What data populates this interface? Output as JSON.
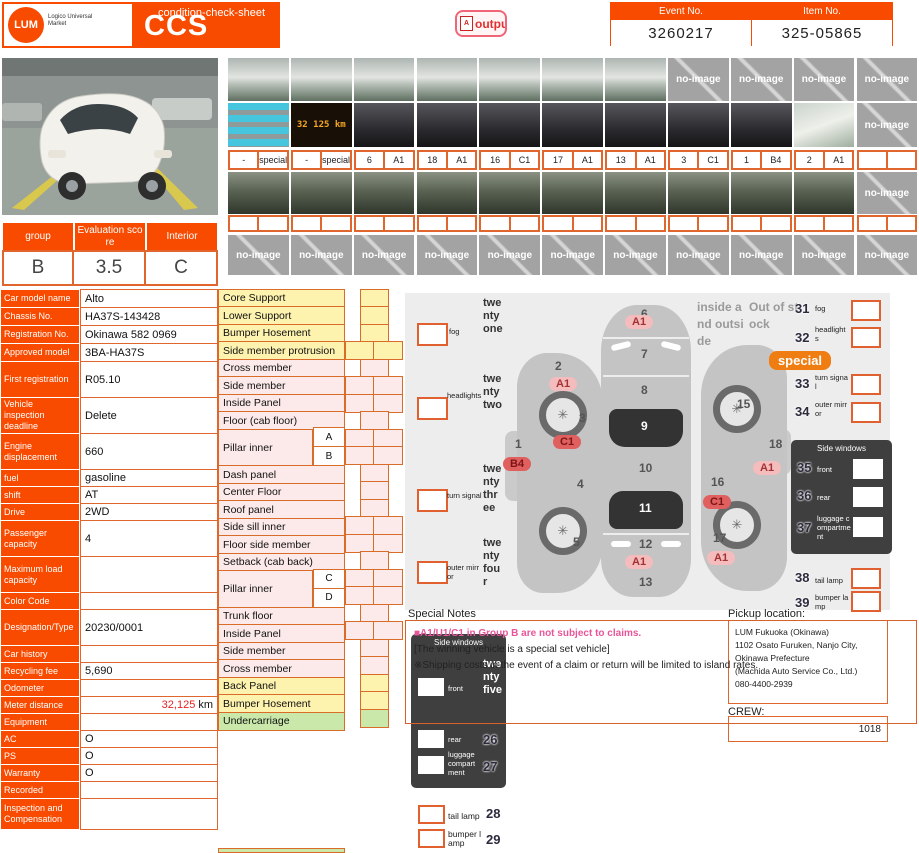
{
  "header": {
    "logo_text": "LUM",
    "logo_sub": "Logico Universal Market",
    "title": "CCS",
    "subtitle": "condition-check-sheet",
    "output_button": "output",
    "output_icon": "pdf-icon",
    "event": {
      "label": "Event No.",
      "value": "3260217"
    },
    "item": {
      "label": "Item No.",
      "value": "325-05865"
    }
  },
  "photos": {
    "no_image": "no-image",
    "odometer_display": "32 125 km",
    "row1_types": [
      "ext",
      "ext",
      "ext",
      "ext",
      "ext",
      "ext",
      "ext",
      "no",
      "no",
      "no",
      "no"
    ],
    "row2_types": [
      "cyan",
      "odo",
      "int",
      "int",
      "int",
      "int",
      "int",
      "int",
      "int",
      "doc",
      "no"
    ],
    "row3_types": [
      "und",
      "und",
      "und",
      "und",
      "und",
      "und",
      "und",
      "und",
      "und",
      "und",
      "no"
    ],
    "row4_types": [
      "no",
      "no",
      "no",
      "no",
      "no",
      "no",
      "no",
      "no",
      "no",
      "no",
      "no"
    ],
    "tag_row1": [
      [
        "-",
        "special"
      ],
      [
        "-",
        "special"
      ],
      [
        "6",
        "A1"
      ],
      [
        "18",
        "A1"
      ],
      [
        "16",
        "C1"
      ],
      [
        "17",
        "A1"
      ],
      [
        "13",
        "A1"
      ],
      [
        "3",
        "C1"
      ],
      [
        "1",
        "B4"
      ],
      [
        "2",
        "A1"
      ],
      [
        "",
        ""
      ]
    ],
    "tag_row2": [
      [
        "",
        ""
      ],
      [
        "",
        ""
      ],
      [
        "",
        ""
      ],
      [
        "",
        ""
      ],
      [
        "",
        ""
      ],
      [
        "",
        ""
      ],
      [
        "",
        ""
      ],
      [
        "",
        ""
      ],
      [
        "",
        ""
      ],
      [
        "",
        ""
      ],
      [
        "",
        ""
      ]
    ]
  },
  "summary": {
    "columns": [
      {
        "label": "group",
        "value": "B"
      },
      {
        "label": "Evaluation score",
        "value": "3.5"
      },
      {
        "label": "Interior",
        "value": "C"
      }
    ]
  },
  "details": {
    "meter_value": "32,125",
    "meter_unit": "km",
    "rows": [
      {
        "label": "Car model name",
        "value": "Alto"
      },
      {
        "label": "Chassis No.",
        "value": "HA37S-143428"
      },
      {
        "label": "Registration No.",
        "value": "Okinawa 582 0969"
      },
      {
        "label": "Approved model",
        "value": "3BA-HA37S"
      },
      {
        "label": "First registration",
        "value": "R05.10"
      },
      {
        "label": "Vehicle inspection deadline",
        "value": "Delete"
      },
      {
        "label": "Engine displacement",
        "value": "660"
      },
      {
        "label": "fuel",
        "value": "gasoline"
      },
      {
        "label": "shift",
        "value": "AT"
      },
      {
        "label": "Drive",
        "value": "2WD"
      },
      {
        "label": "Passenger capacity",
        "value": "4"
      },
      {
        "label": "Maximum load capacity",
        "value": ""
      },
      {
        "label": "Color Code",
        "value": ""
      },
      {
        "label": "Designation/Type",
        "value": "20230/0001"
      },
      {
        "label": "Car history",
        "value": ""
      },
      {
        "label": "Recycling fee",
        "value": "5,690"
      },
      {
        "label": "Odometer",
        "value": ""
      },
      {
        "label": "Meter distance",
        "value": "",
        "meter": true
      },
      {
        "label": "Equipment",
        "value": ""
      },
      {
        "label": "AC",
        "value": "O"
      },
      {
        "label": "PS",
        "value": "O"
      },
      {
        "label": "Warranty",
        "value": "O"
      },
      {
        "label": "Recorded",
        "value": ""
      },
      {
        "label": "Inspection and Compensation",
        "value": ""
      }
    ]
  },
  "parts": {
    "rows": [
      {
        "label": "Core Support",
        "color": "yel",
        "strip": "s"
      },
      {
        "label": "Lower Support",
        "color": "yel",
        "strip": "s"
      },
      {
        "label": "Bumper Hosement",
        "color": "yel",
        "strip": "s"
      },
      {
        "label": "Side member protrusion",
        "color": "yel",
        "strip": "p"
      },
      {
        "label": "Cross member",
        "color": "pnk",
        "strip": "s"
      },
      {
        "label": "Side member",
        "color": "pnk",
        "strip": "p"
      },
      {
        "label": "Inside Panel",
        "color": "pnk",
        "strip": "p"
      },
      {
        "label": "Floor (cab floor)",
        "color": "pnk",
        "strip": "s"
      },
      {
        "label": "Pillar inner",
        "color": "pnk",
        "strip": "p2",
        "sub": [
          "A",
          "B"
        ]
      },
      {
        "label": "Dash panel",
        "color": "pnk",
        "strip": "s"
      },
      {
        "label": "Center Floor",
        "color": "pnk",
        "strip": "s"
      },
      {
        "label": "Roof panel",
        "color": "pnk",
        "strip": "s"
      },
      {
        "label": "Side sill inner",
        "color": "pnk",
        "strip": "p"
      },
      {
        "label": "Floor side member",
        "color": "pnk",
        "strip": "p"
      },
      {
        "label": "Setback (cab back)",
        "color": "pnk",
        "strip": "s"
      },
      {
        "label": "Pillar inner",
        "color": "pnk",
        "strip": "p2",
        "sub": [
          "C",
          "D"
        ]
      },
      {
        "label": "Trunk floor",
        "color": "pnk",
        "strip": "s"
      },
      {
        "label": "Inside Panel",
        "color": "pnk",
        "strip": "p"
      },
      {
        "label": "Side member",
        "color": "pnk",
        "strip": "s"
      },
      {
        "label": "Cross member",
        "color": "pnk",
        "strip": "s"
      },
      {
        "label": "Back Panel",
        "color": "yel",
        "strip": "s"
      },
      {
        "label": "Bumper Hosement",
        "color": "yel",
        "strip": "s"
      },
      {
        "label": "Undercarriage",
        "color": "grn",
        "strip": "s"
      }
    ]
  },
  "diagram": {
    "zones": [
      "1",
      "2",
      "3",
      "4",
      "5",
      "6",
      "7",
      "8",
      "9",
      "10",
      "11",
      "12",
      "13",
      "14",
      "15",
      "16",
      "17",
      "18"
    ],
    "badge_a1": "A1",
    "badge_b4": "B4",
    "badge_c1": "C1",
    "special_badge": "special",
    "inside_outside": "inside and outside",
    "out_of_stock": "Out of stock",
    "left_checks": [
      {
        "num": "twentyone",
        "label": "fog"
      },
      {
        "num": "twentytwo",
        "label": "headlights"
      },
      {
        "num": "twentythree",
        "label": "turn signal"
      },
      {
        "num": "twentyfour",
        "label": "outer mirror"
      }
    ],
    "right_checks": [
      {
        "num": "31",
        "label": "fog"
      },
      {
        "num": "32",
        "label": "headlights"
      },
      {
        "num": "33",
        "label": "turn signal"
      },
      {
        "num": "34",
        "label": "outer mirror"
      },
      {
        "num": "38",
        "label": "tail lamp"
      },
      {
        "num": "39",
        "label": "bumper lamp"
      }
    ],
    "side_windows_right": {
      "title": "Side windows",
      "rows": [
        {
          "num": "35",
          "label": "front"
        },
        {
          "num": "36",
          "label": "rear"
        },
        {
          "num": "37",
          "label": "luggage compartment"
        }
      ]
    },
    "side_windows_left": {
      "title": "Side windows",
      "rows": [
        {
          "num": "twentyfive",
          "label": "front"
        },
        {
          "num": "26",
          "label": "rear"
        },
        {
          "num": "27",
          "label": "luggage compartment"
        }
      ]
    },
    "bottom_checks": [
      {
        "num": "28",
        "label": "tail lamp"
      },
      {
        "num": "29",
        "label": "bumper lamp"
      }
    ]
  },
  "notes": {
    "title": "Special Notes",
    "line1": "■A1/U1/C1 in Group B are not subject to claims.",
    "line2": "[The winning vehicle is a special set vehicle]",
    "line3": "※Shipping costs in the event of a claim or return will be limited to island rates."
  },
  "pickup": {
    "label": "Pickup location:",
    "lines": [
      "LUM Fukuoka (Okinawa)",
      "1102 Osato Furuken, Nanjo City, Okinawa Prefecture",
      "(Machida Auto Service Co., Ltd.)",
      "080-4400-2939"
    ],
    "crew_label": "CREW:",
    "crew_value": "1018"
  }
}
